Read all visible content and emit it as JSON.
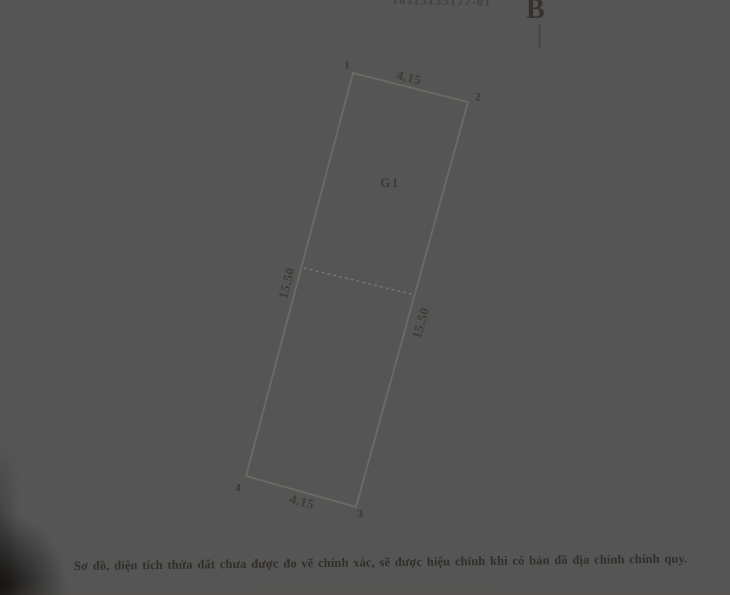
{
  "document": {
    "reference_number": "10113133177-01",
    "north_symbol": "B",
    "caption": "Sơ đồ, diện tích thửa đất chưa được đo vẽ chính xác, sẽ được hiệu chỉnh khi có bản đồ địa chính chính quy."
  },
  "plot": {
    "label": "G1",
    "corner_labels": [
      "1",
      "2",
      "3",
      "4"
    ],
    "dimensions": {
      "top_edge": "4.15",
      "bottom_edge": "4.15",
      "left_edge": "15.50",
      "right_edge": "15.50"
    }
  },
  "colors": {
    "paper": "#e5e2db",
    "ink": "#3b3731",
    "boundary_line": "#6e6a62"
  }
}
